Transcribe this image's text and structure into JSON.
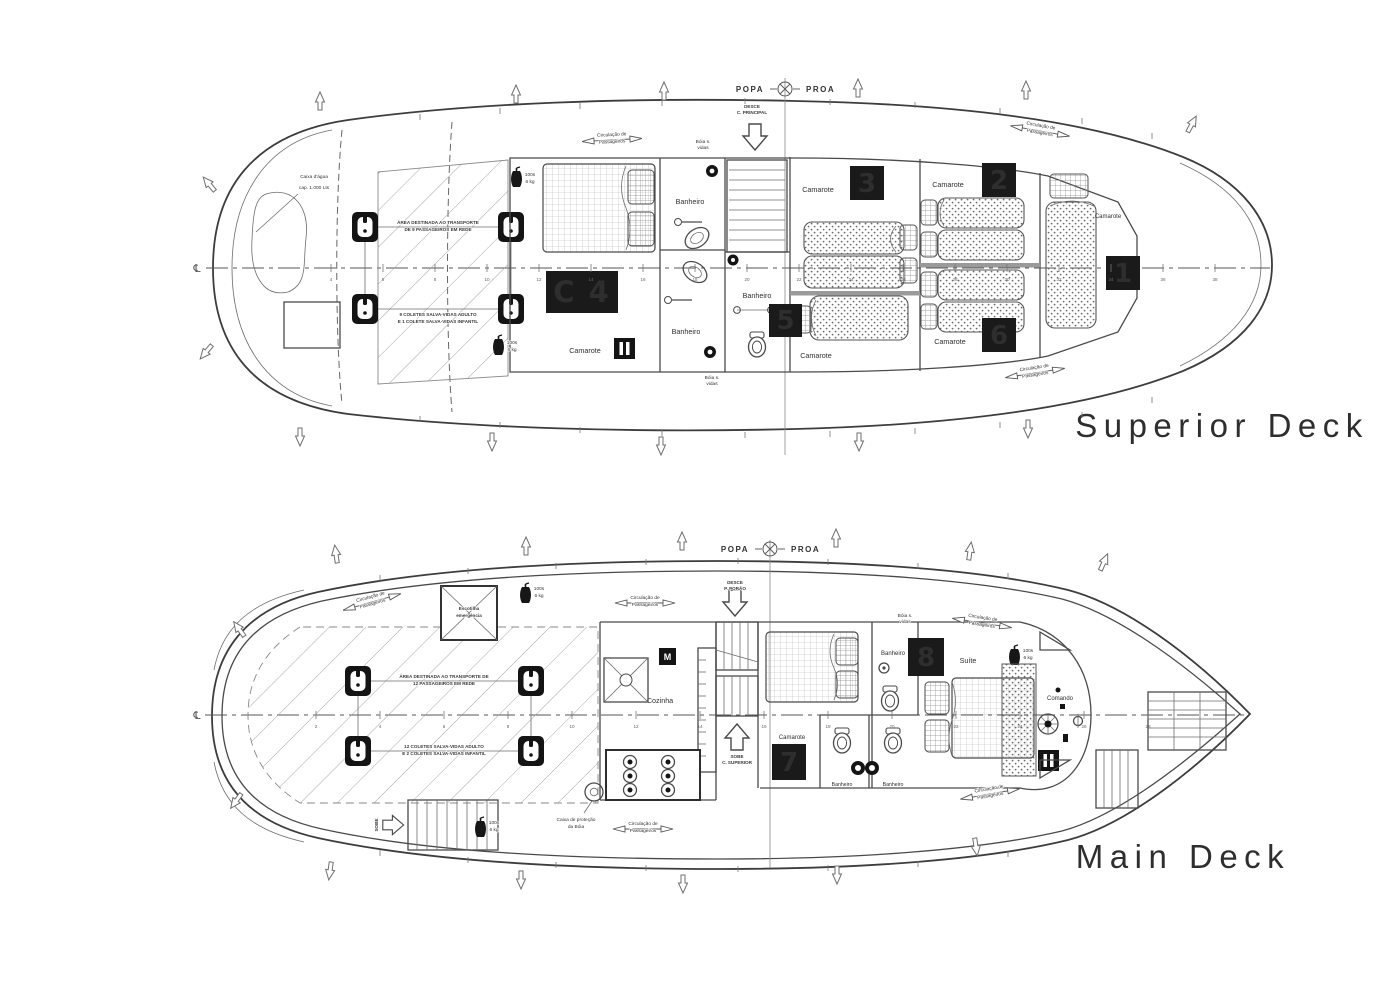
{
  "titles": {
    "superior": "Superior Deck",
    "main": "Main Deck"
  },
  "colors": {
    "title": "#22384e",
    "badge_bg": "#1a1a1a",
    "badge_text": "#f4f3ec"
  },
  "orientation": {
    "popa": "POPA",
    "proa": "PROA",
    "centerline": "℄"
  },
  "badges": {
    "n1": "1",
    "n2": "2",
    "n3": "3",
    "c4": "C 4",
    "n5": "5",
    "n6": "6",
    "n7": "7",
    "n8": "8"
  },
  "rooms": {
    "camarote": "Camarote",
    "banheiro": "Banheiro",
    "cozinha": "Cozinha",
    "suite": "Suíte",
    "comando": "Comando"
  },
  "annotations": {
    "caixa_dagua_l1": "Caixa d'água",
    "caixa_dagua_l2": "cap. 1.000 Lts",
    "area_sup_l1": "ÁREA DESTINADA AO TRANSPORTE",
    "area_sup_l2": "DE 9 PASSAGEIROS EM REDE",
    "coletes_sup_l1": "9 COLETES SALVA-VIDAS ADULTO",
    "coletes_sup_l2": "E 1 COLETE SALVA-VIDAS INFANTIL",
    "area_main_l1": "ÁREA DESTINADA AO TRANSPORTE DE",
    "area_main_l2": "12 PASSAGEIROS EM REDE",
    "coletes_main_l1": "12 COLETES SALVA-VIDAS ADULTO",
    "coletes_main_l2": "E 2 COLETES SALVA-VIDAS INFANTIL",
    "circ_l1": "Circulação de",
    "circ_l2": "Passageiros",
    "boia_l1": "Bóia s.",
    "boia_l2": "vidas",
    "caixa_boia_l1": "Caixa de proteção",
    "caixa_boia_l2": "da Bóia",
    "escotilha_l1": "Escotilha",
    "escotilha_l2": "emergência",
    "desce_l1": "DESCE",
    "desce_l2": "C. PRINCIPAL",
    "sobe_l1": "SOBE",
    "sobe_l2": "C. SUPERIOR",
    "desce_porao_l1": "DESCE",
    "desce_porao_l2": "P. PORÃO",
    "sobe_short": "SOBE",
    "ext_l1": "100s",
    "ext_l2": "6 kg",
    "m_label": "M"
  },
  "stations": {
    "superior": [
      "4",
      "6",
      "8",
      "10",
      "12",
      "14",
      "16",
      "18",
      "20",
      "22",
      "24",
      "26",
      "28",
      "30",
      "32",
      "34",
      "36",
      "38"
    ],
    "main": [
      "2",
      "4",
      "6",
      "8",
      "10",
      "12",
      "14",
      "16",
      "18",
      "20",
      "22",
      "24",
      "26",
      "28"
    ]
  }
}
